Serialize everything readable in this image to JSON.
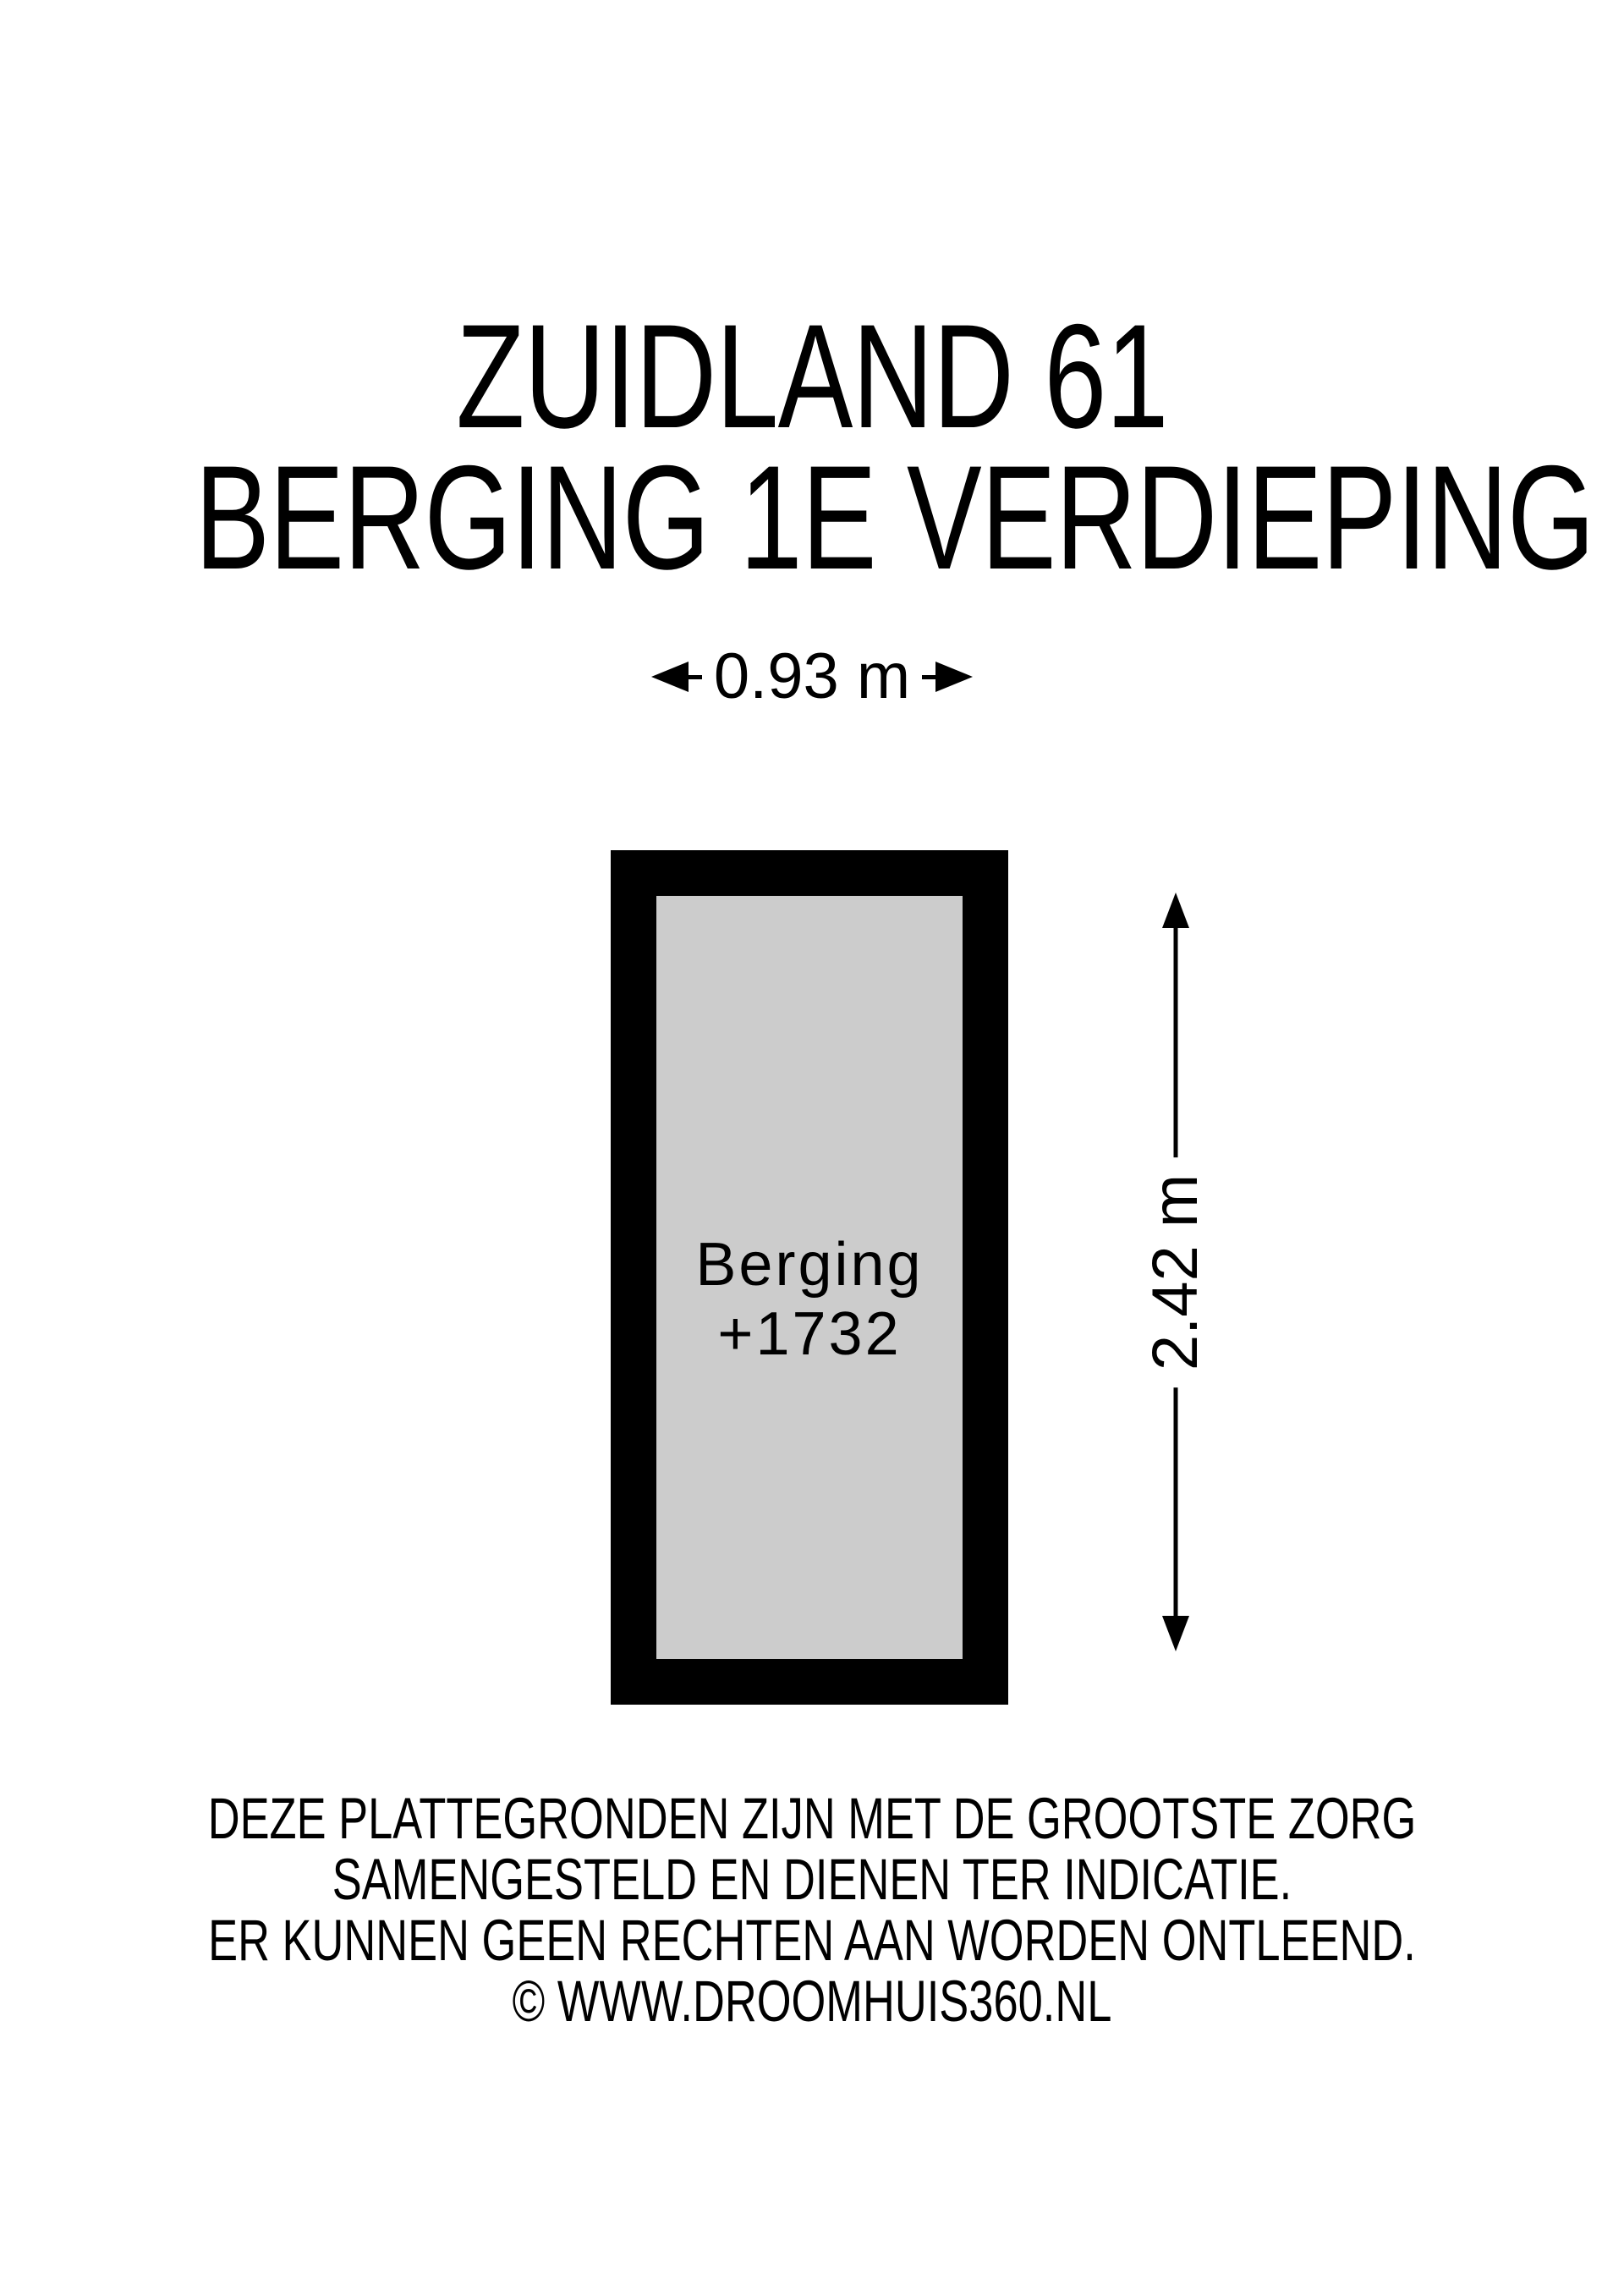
{
  "title": {
    "line1": "ZUIDLAND 61",
    "line2": "BERGING 1E VERDIEPING"
  },
  "floorplan": {
    "width_label": "0.93 m",
    "height_label": "2.42 m",
    "room": {
      "name": "Berging",
      "number": "+1732"
    },
    "colors": {
      "wall": "#000000",
      "floor": "#cccccc",
      "background": "#ffffff",
      "text": "#000000"
    }
  },
  "disclaimer": {
    "lines": [
      "DEZE PLATTEGRONDEN ZIJN MET DE GROOTSTE ZORG",
      "SAMENGESTELD EN DIENEN TER INDICATIE.",
      "ER KUNNEN GEEN RECHTEN AAN WORDEN ONTLEEND.",
      "© WWW.DROOMHUIS360.NL"
    ]
  }
}
